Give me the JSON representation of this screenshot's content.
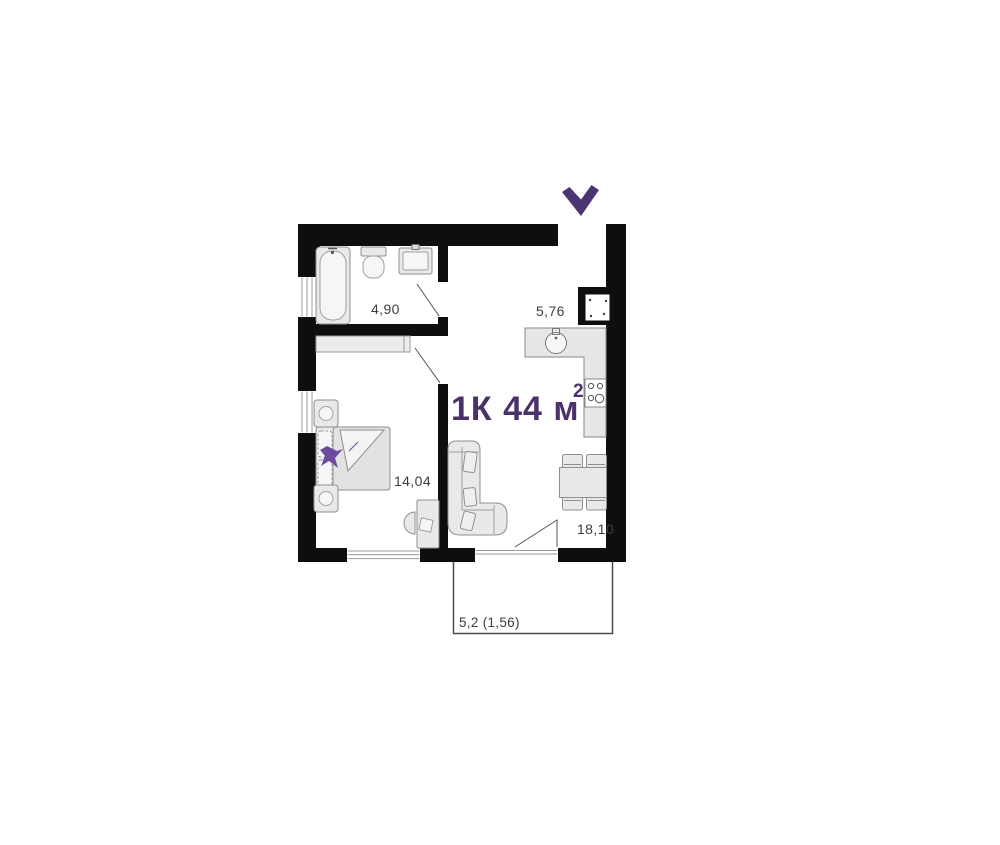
{
  "plan": {
    "title": {
      "main": "1К 44 м",
      "sup": "2"
    },
    "rooms": [
      {
        "id": "bathroom",
        "area": "4,90"
      },
      {
        "id": "kitchen",
        "area": "5,76"
      },
      {
        "id": "bedroom",
        "area": "14,04"
      },
      {
        "id": "living-room",
        "area": "18,10"
      },
      {
        "id": "balcony",
        "area": "5,2 (1,56)"
      }
    ],
    "colors": {
      "accent": "#4a3269",
      "walls": "#0e0e0e",
      "furniture_fill": "#e9e9e9",
      "furniture_stroke": "#8f8f8f",
      "label": "#3c3c3c"
    },
    "icons": [
      "entrance-chevron-icon",
      "bathtub-icon",
      "toilet-icon",
      "washbasin-icon",
      "kitchen-sink-icon",
      "stove-icon",
      "vent-shaft-icon",
      "dining-table-icon",
      "chair-icon",
      "sofa-icon",
      "bed-icon",
      "nightstand-icon",
      "plant-icon",
      "wardrobe-icon",
      "desk-icon",
      "desk-chair-icon"
    ]
  }
}
